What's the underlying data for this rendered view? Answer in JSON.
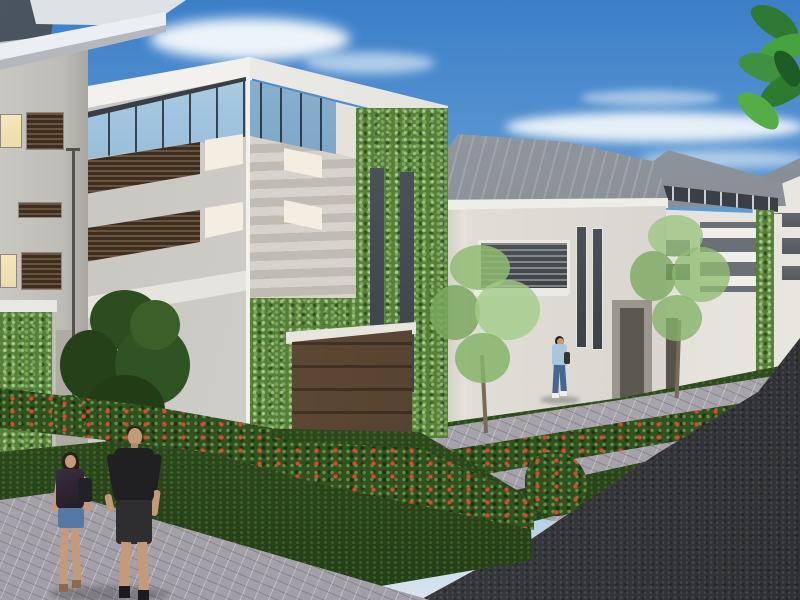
{
  "meta": {
    "type": "architectural-rendering",
    "subject": "Street-level rendering of a modern townhouse development with ivy-covered facades"
  },
  "scene": {
    "sky": {
      "description": "clear blue sky, lighter toward horizon",
      "clouds": "wispy white streaks upper-left and center-right"
    },
    "foliage_overhang": {
      "position": "top-right corner",
      "type": "green palm leaves entering frame"
    },
    "buildings": [
      {
        "id": "left-building",
        "position": "left edge, cropped",
        "features": [
          "dark corner glass window",
          "white angled roof eave",
          "warm lit windows",
          "brown louver blinds",
          "ivy-covered base",
          "thin lamp post"
        ]
      },
      {
        "id": "main-building",
        "position": "left-center foreground, three storeys",
        "features": [
          "white parapet",
          "wrap-around clerestory glass band",
          "two brown louver window rows",
          "horizontal siding bands with two small windows",
          "ivy-covered tower",
          "two slim dark vertical windows",
          "brown panel garage door"
        ]
      },
      {
        "id": "second-house",
        "position": "center-right, mid distance",
        "features": [
          "grey hipped roof",
          "white walls",
          "framed horizontal window band",
          "two slim vertical windows",
          "recessed dark entry door"
        ]
      },
      {
        "id": "third-house",
        "position": "right, farther",
        "features": [
          "grey hipped roof",
          "dark clerestory band",
          "thin horizontal windows",
          "white balcony bands",
          "ivy strip",
          "dark door"
        ]
      },
      {
        "id": "distant-houses",
        "position": "far right edge",
        "features": [
          "white tower with stacked dark window bands",
          "grey roof wedge"
        ]
      }
    ],
    "ground": {
      "elements": [
        "light paver walkway in foreground",
        "paver driveways running to the road",
        "dark green lawns",
        "flowering hedges with red blooms",
        "dark asphalt road lower-right"
      ]
    },
    "vegetation": {
      "trees": [
        "dense dark green tree by left building",
        "sparse light green tree before second house",
        "sparse light green tree before third house"
      ],
      "flowers": "red blooms scattered along every hedge and a bush beside the road"
    },
    "people": [
      {
        "id": "couple-man",
        "description": "man in black t-shirt, dark shorts and dark shoes walking away on the pavers"
      },
      {
        "id": "couple-woman",
        "description": "woman with dark hair, dark patterned top, denim shorts and shoulder bag holding hands with the man"
      },
      {
        "id": "distant-woman",
        "description": "small figure in light blue top and jeans walking on a driveway mid-scene"
      }
    ]
  },
  "colors": {
    "sky_top": "#3c7fc8",
    "sky_mid": "#74a9d9",
    "sky_horizon": "#d8e5ef",
    "cloud": "#f7fafc",
    "wall_light": "#e9e6e0",
    "wall_mid": "#cdcbc5",
    "wall_shadow": "#b2afa8",
    "parapet": "#f2f1ed",
    "glass_sky": "#b9d8ec",
    "glass_deep": "#527ea4",
    "frame_dark": "#3a3f45",
    "louver_light": "#6a543e",
    "louver_dark": "#3e2e1f",
    "window_warm": "#ecdca8",
    "window_white": "#f3eedf",
    "window_dark": "#3c4248",
    "ivy_base": "#567f3a",
    "hedge_base": "#31511f",
    "flower_red": "#d63826",
    "lawn_dark": "#2c491d",
    "paver": "#b7b3ba",
    "road": "#37393c",
    "roof": "#878c94",
    "roof_dark": "#5f646c",
    "garage_light": "#6b5440",
    "garage_dark": "#463526",
    "skin": "#c59a7a",
    "hair_dark": "#26201a",
    "tee_black": "#202022",
    "shorts_dark": "#2e2d30",
    "denim": "#5577a2",
    "top_blue": "#a9c6da",
    "jeans": "#47688e",
    "tree_dark": "#2c4d1e",
    "tree_light": "#8fbc72",
    "leaf_green": "#3f9140"
  }
}
